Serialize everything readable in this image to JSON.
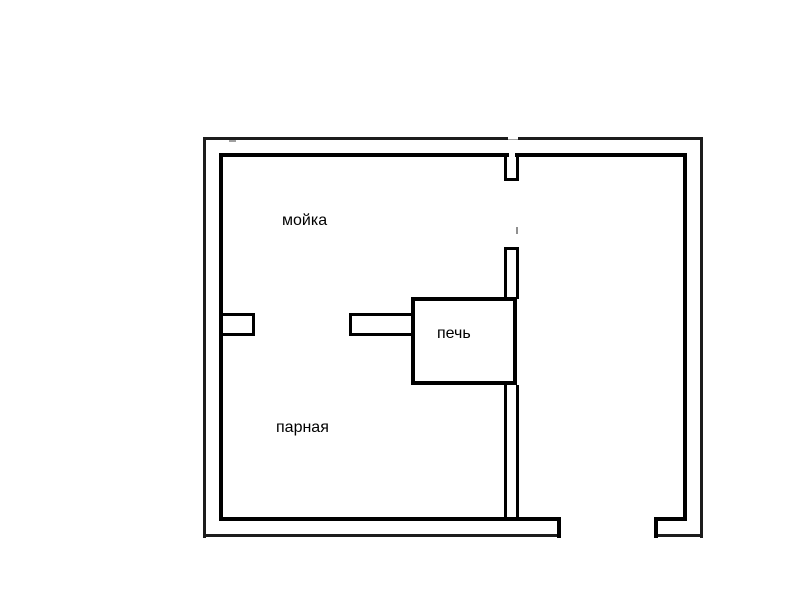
{
  "diagram": {
    "type": "floor-plan",
    "background_color": "#ffffff",
    "wall_color": "#000000",
    "labels": {
      "washing_room": "мойка",
      "steam_room": "парная",
      "stove": "печь"
    }
  }
}
